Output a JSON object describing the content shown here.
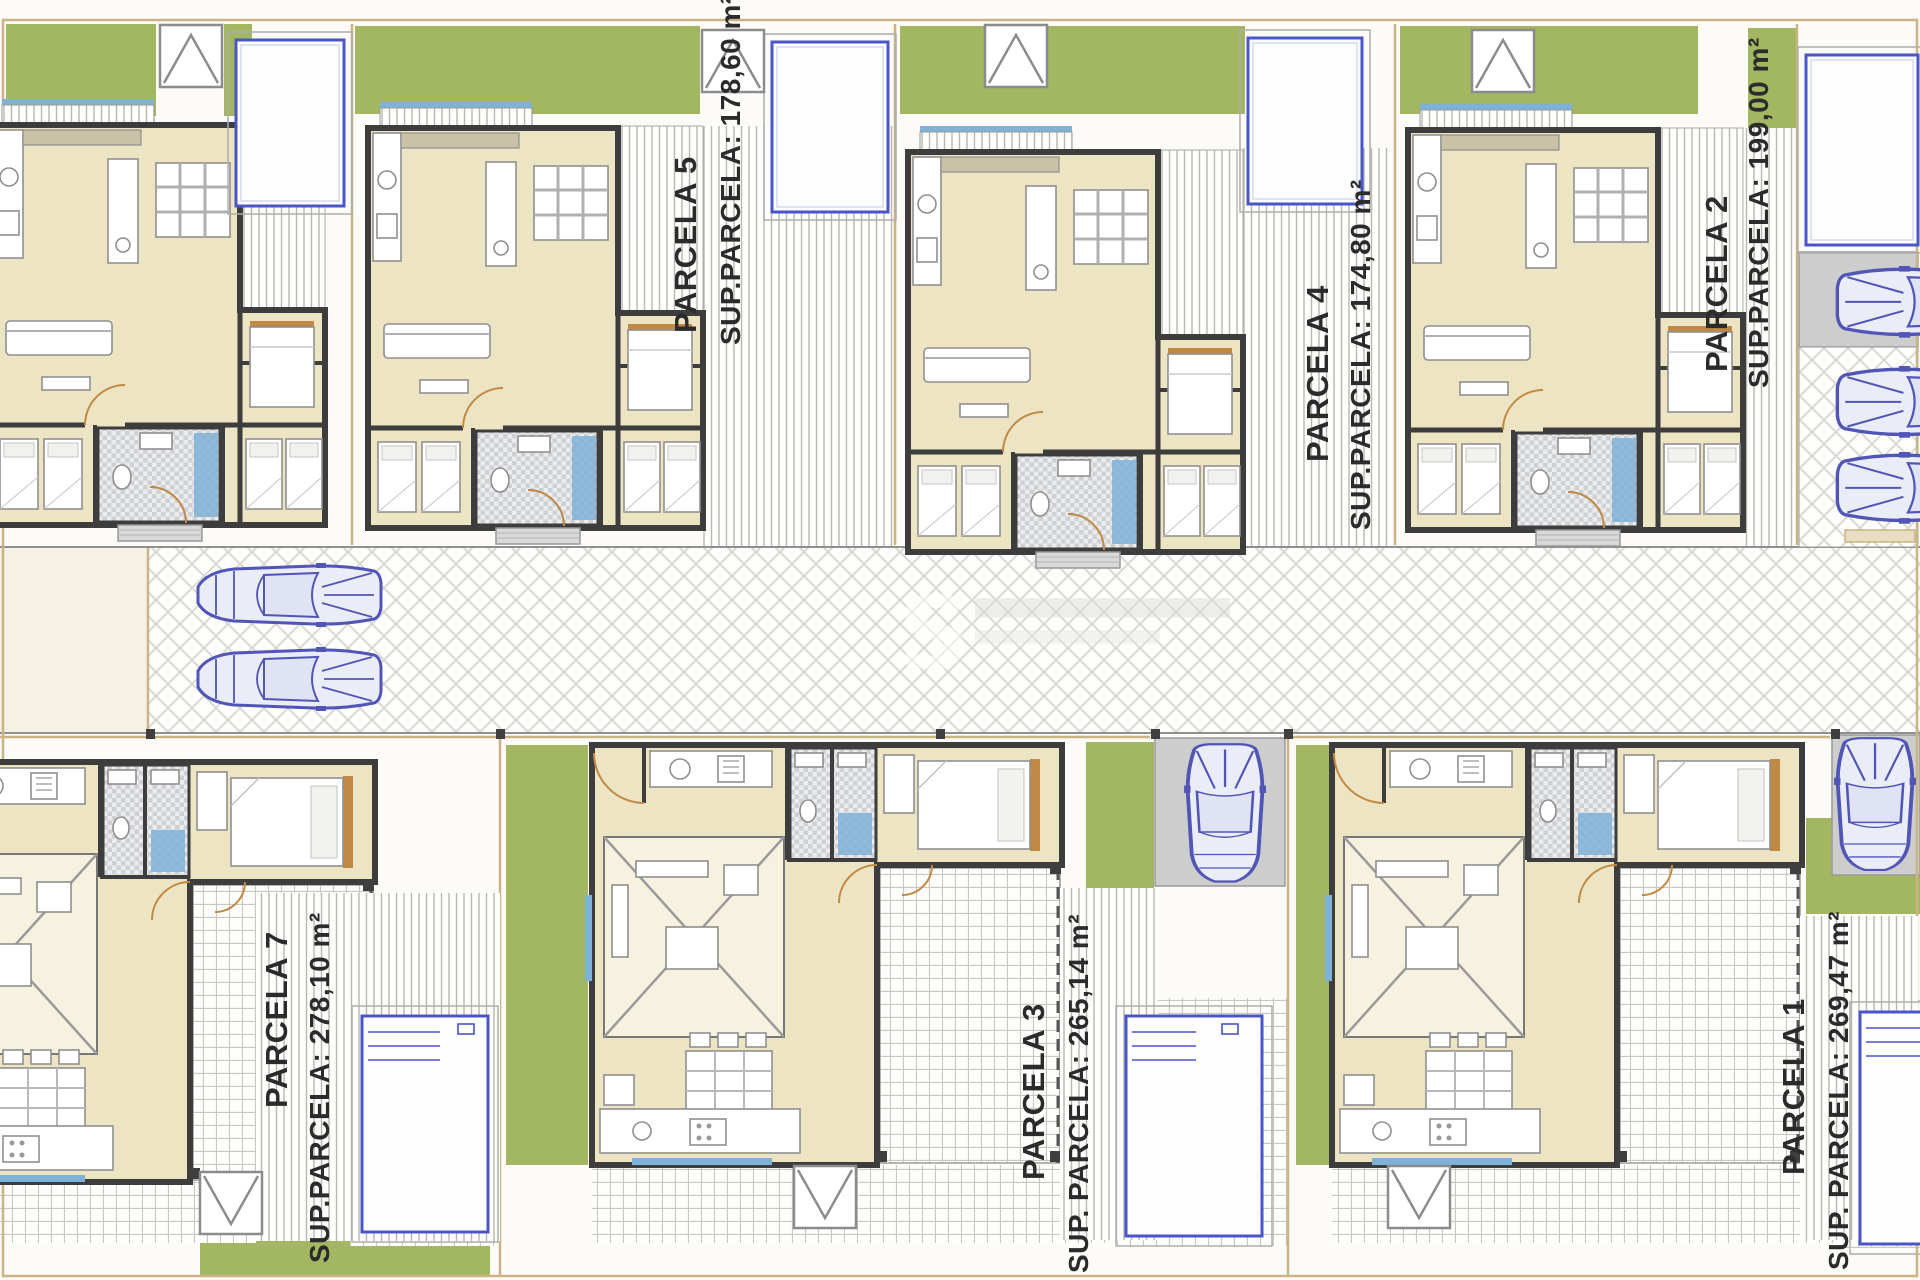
{
  "plan": {
    "watermark_letter": "S",
    "parcels": [
      {
        "key": "p5",
        "name": "PARCELA 5",
        "sup": "SUP.PARCELA: 178,60 m²"
      },
      {
        "key": "p4",
        "name": "PARCELA 4",
        "sup": "SUP.PARCELA: 174,80 m²"
      },
      {
        "key": "p2",
        "name": "PARCELA 2",
        "sup": "SUP.PARCELA: 199,00 m²"
      },
      {
        "key": "p7",
        "name": "PARCELA 7",
        "sup": "SUP.PARCELA: 278,10 m²"
      },
      {
        "key": "p3",
        "name": "PARCELA 3",
        "sup": "SUP. PARCELA: 265,14 m²"
      },
      {
        "key": "p1",
        "name": "PARCELA 1",
        "sup": "SUP. PARCELA: 269,47 m²"
      }
    ],
    "colors": {
      "grass": "#a3b762",
      "floor": "#ece4c2",
      "wall": "#3d3d3d",
      "pool": "#4a55c8",
      "car": "#5156b6",
      "boundary": "#c9b483",
      "label": "#2b2b2b",
      "water": "#7fb2d8",
      "wood": "#c08a45"
    }
  }
}
